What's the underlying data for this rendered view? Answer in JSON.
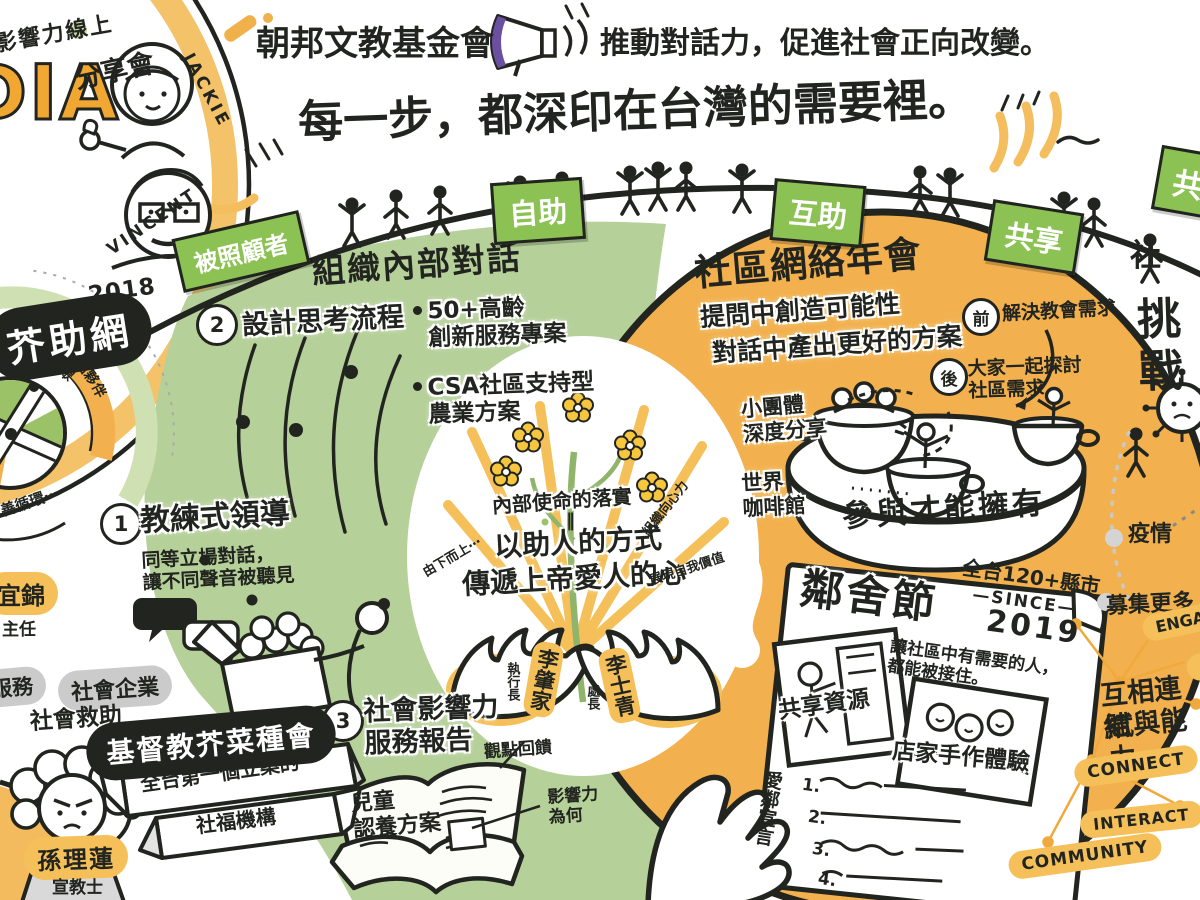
{
  "colors": {
    "ink": "#22241f",
    "green_banner": "#8cc153",
    "green_area": "#b5d099",
    "orange_area": "#f2b14e",
    "orange_accent": "#f5c05a",
    "gray": "#cbcbcb",
    "purple": "#6b4fa0"
  },
  "header": {
    "org": "朝邦文教基金會",
    "tagline": "推動對話力，促進社會正向改變。",
    "title": "每一步，都深印在台灣的需要裡。"
  },
  "webinar": {
    "line1": "影響力線上",
    "acronym": "DIA",
    "line2": "分享會",
    "speaker1": "JACKIE",
    "speaker2": "VINCENT"
  },
  "banners": {
    "care": "被照顧者",
    "self_help": "自助",
    "mutual_help": "互助",
    "share": "共享",
    "share2": "共",
    "partial": "社"
  },
  "jia": {
    "year": "2018",
    "name": "芥助網",
    "arc_top": "者・一般大眾",
    "ribbon": "共好點夥伴",
    "cycle": "善循環⋯",
    "person": "宜錦",
    "person_title": "主任"
  },
  "internal": {
    "heading": "組織內部對話",
    "n1": "1",
    "n2": "2",
    "n3": "3",
    "s2": "設計思考流程",
    "b1": "50+高齡\n創新服務專案",
    "b2": "CSA社區支持型\n農業方案",
    "s1": "教練式領導",
    "s1desc": "同等立場對話，\n讓不同聲音被聽見",
    "s3": "社會影響力\n服務報告",
    "book": "兒童\n認養方案",
    "note1": "觀點回饋",
    "note2": "影響力\n為何"
  },
  "mission": {
    "top": "內部使命的落實",
    "eq": "‖",
    "mid": "以助人的方式",
    "bottom": "傳遞上帝愛人的心",
    "left": "由下而上⋯",
    "tr": "組織向心力",
    "br": "展現自我價值",
    "p1": "李肇家",
    "p1t": "執行長",
    "p2": "李士青",
    "p2t": "處長"
  },
  "annual": {
    "heading": "社區網絡年會",
    "sub1": "提問中創造可能性",
    "sub2": "對話中產出更好的方案",
    "before_badge": "前",
    "before": "解決教會需求",
    "after_badge": "後",
    "after": "大家一起探討\n社區需求",
    "group": "小團體\n深度分享",
    "cafe": "世界\n咖啡館",
    "table": "參與才能擁有"
  },
  "poster": {
    "title": "鄰舍節",
    "scope": "全台120+縣市",
    "since": "—SINCE—",
    "year": "2019",
    "desc": "讓社區中有需要的人，\n都能被接住。",
    "photo1": "共享資源",
    "photo2": "店家手作體驗",
    "manifesto": "愛鄰宣言",
    "i1": "1.",
    "i2": "2.",
    "i3": "3.",
    "i4": "4."
  },
  "right": {
    "challenge": "挑戰",
    "pandemic": "疫情",
    "fundraise": "募集更多",
    "engage": "ENGAGE",
    "engage2": "ENGAGE",
    "link1": "互相連結",
    "link2": "賦與能力",
    "w1": "CONNECT",
    "w2": "INTERACT",
    "w3": "COMMUNITY"
  },
  "mustard": {
    "t1": "服務",
    "t2": "社會企業",
    "t3": "社會救助",
    "org": "基督教芥菜種會",
    "ribbon1": "全台第一個立案的",
    "ribbon2": "社福機構",
    "person": "孫理蓮",
    "person_title": "宣教士"
  }
}
